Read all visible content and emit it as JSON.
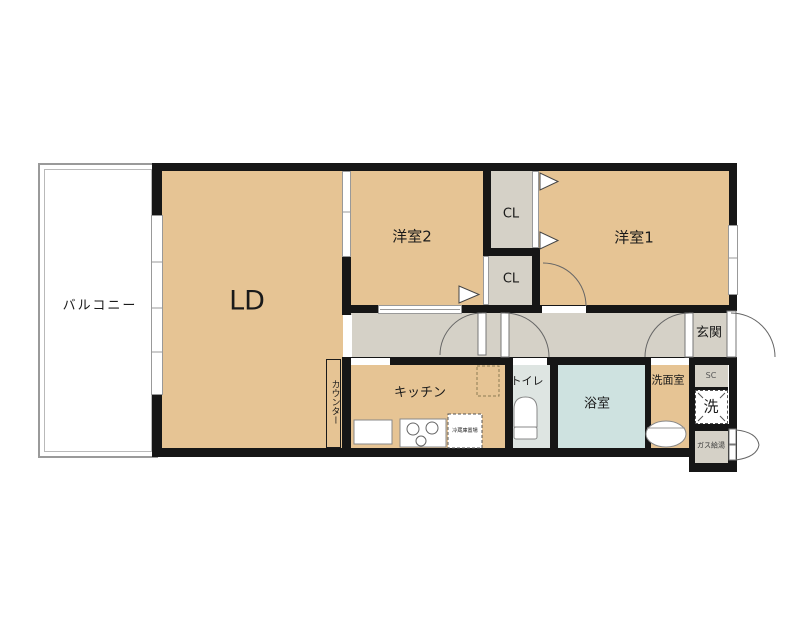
{
  "labels": {
    "balcony": "バルコニー",
    "living_dining": "LD",
    "western_room_2": "洋室2",
    "western_room_1": "洋室1",
    "closet_upper": "CL",
    "closet_lower": "CL",
    "entrance": "玄関",
    "kitchen": "キッチン",
    "toilet": "トイレ",
    "bathroom": "浴室",
    "washroom": "洗面室",
    "shoe_closet": "SC",
    "laundry": "洗",
    "gas_water_heater": "ガス給湯",
    "counter": "カウンター",
    "refrigerator_space": "冷蔵庫置場"
  },
  "colors": {
    "room_tan": "#e6c494",
    "hall_gray": "#d5d1c7",
    "bath_blue": "#cee2e0",
    "toilet_gray": "#dee5e2",
    "wall_black": "#161616"
  }
}
